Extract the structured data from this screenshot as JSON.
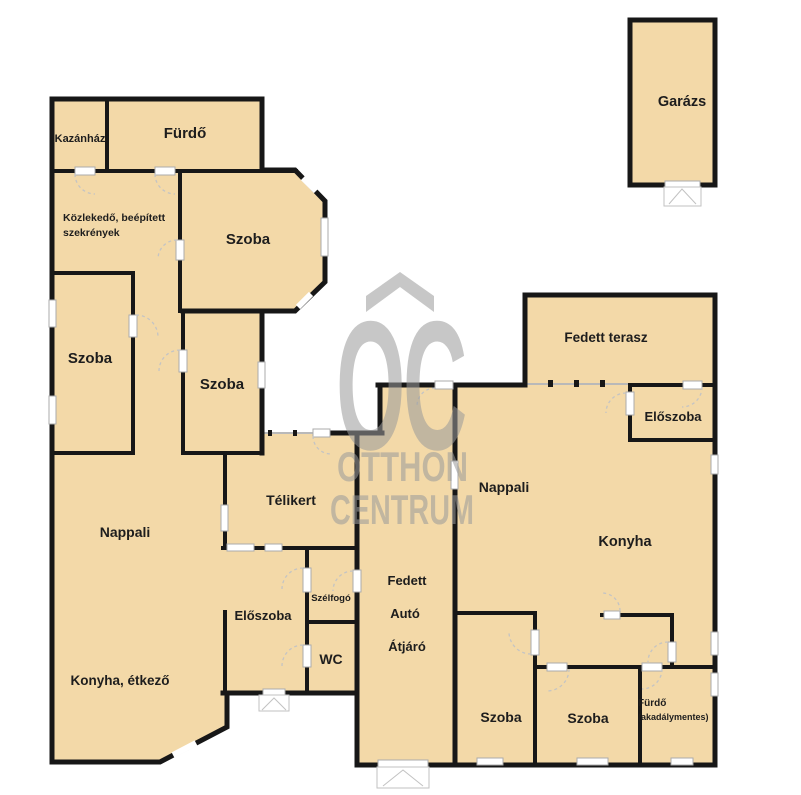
{
  "title": "Otthon Centrum alaprajz",
  "palette": {
    "floor_fill": "#f3d9a8",
    "wall": "#171717",
    "label": "#1d1d1d",
    "watermark_gray": "#9a9a9a",
    "door_arc": "#c4c4c4",
    "opening_frame": "#ababab",
    "open_boundary": "#b9b9b9",
    "background": "#ffffff"
  },
  "watermark": {
    "logo_text": "OC",
    "line1": "OTTHON",
    "line2": "CENTRUM"
  },
  "rooms": {
    "kazanhaz": "Kazánház",
    "furdo_top": "Fürdő",
    "kozlekedo_line1": "Közlekedő, beépített",
    "kozlekedo_line2": "szekrények",
    "szoba_bay": "Szoba",
    "szoba_left": "Szoba",
    "szoba_middle": "Szoba",
    "telikert": "Télikert",
    "nappali_left": "Nappali",
    "eloszoba_left": "Előszoba",
    "szelfogo": "Szélfogó",
    "wc": "WC",
    "konyha_etkezo": "Konyha, étkező",
    "fedett_auto_atjaro_line1": "Fedett",
    "fedett_auto_atjaro_line2": "Autó",
    "fedett_auto_atjaro_line3": "Átjáró",
    "fedett_terasz": "Fedett terasz",
    "eloszoba_right": "Előszoba",
    "nappali_right": "Nappali",
    "konyha_right": "Konyha",
    "szoba_bottom_left": "Szoba",
    "szoba_bottom_right": "Szoba",
    "furdo_akadalymentes_line1": "Fürdő",
    "furdo_akadalymentes_line2": "(akadálymentes)",
    "garazs": "Garázs"
  }
}
